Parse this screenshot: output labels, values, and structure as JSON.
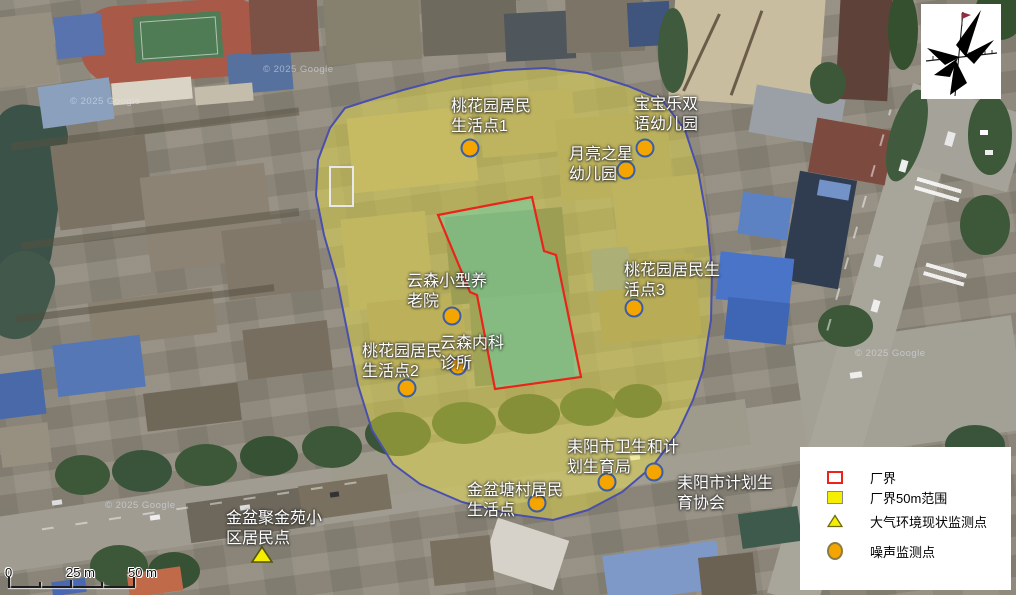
{
  "colors": {
    "buffer_fill": "#F0E43C",
    "buffer_stroke": "#4A4FAE",
    "boundary_stroke": "#EA2418",
    "boundary_fill": "#69D2AA",
    "noise_fill": "#F5A500",
    "noise_stroke": "#3A5FA8",
    "air_fill": "#F5EE00",
    "air_stroke": "#55550F"
  },
  "markers": [
    {
      "label": "桃花园居民\n生活点1",
      "type": "noise"
    },
    {
      "label": "宝宝乐双\n语幼儿园",
      "type": "noise"
    },
    {
      "label": "月亮之星\n幼儿园",
      "type": "noise"
    },
    {
      "label": "桃花园居民生\n活点3",
      "type": "noise"
    },
    {
      "label": "云森小型养\n老院",
      "type": "noise"
    },
    {
      "label": "云森内科\n诊所",
      "type": "noise"
    },
    {
      "label": "桃花园居民\n生活点2",
      "type": "noise"
    },
    {
      "label": "耒阳市卫生和计\n划生育局",
      "type": "noise"
    },
    {
      "label": "耒阳市计划生\n育协会",
      "type": "noise"
    },
    {
      "label": "金盆塘村居民\n生活点",
      "type": "noise"
    },
    {
      "label": "金盆聚金苑小\n区居民点",
      "type": "air"
    }
  ],
  "legend": {
    "items": [
      {
        "label": "厂界"
      },
      {
        "label": "厂界50m范围"
      },
      {
        "label": "大气环境现状监测点"
      },
      {
        "label": "噪声监测点"
      }
    ]
  },
  "scalebar": {
    "labels": [
      "0",
      "25 m",
      "50 m"
    ]
  },
  "watermark": {
    "text": "© 2025 Google"
  }
}
